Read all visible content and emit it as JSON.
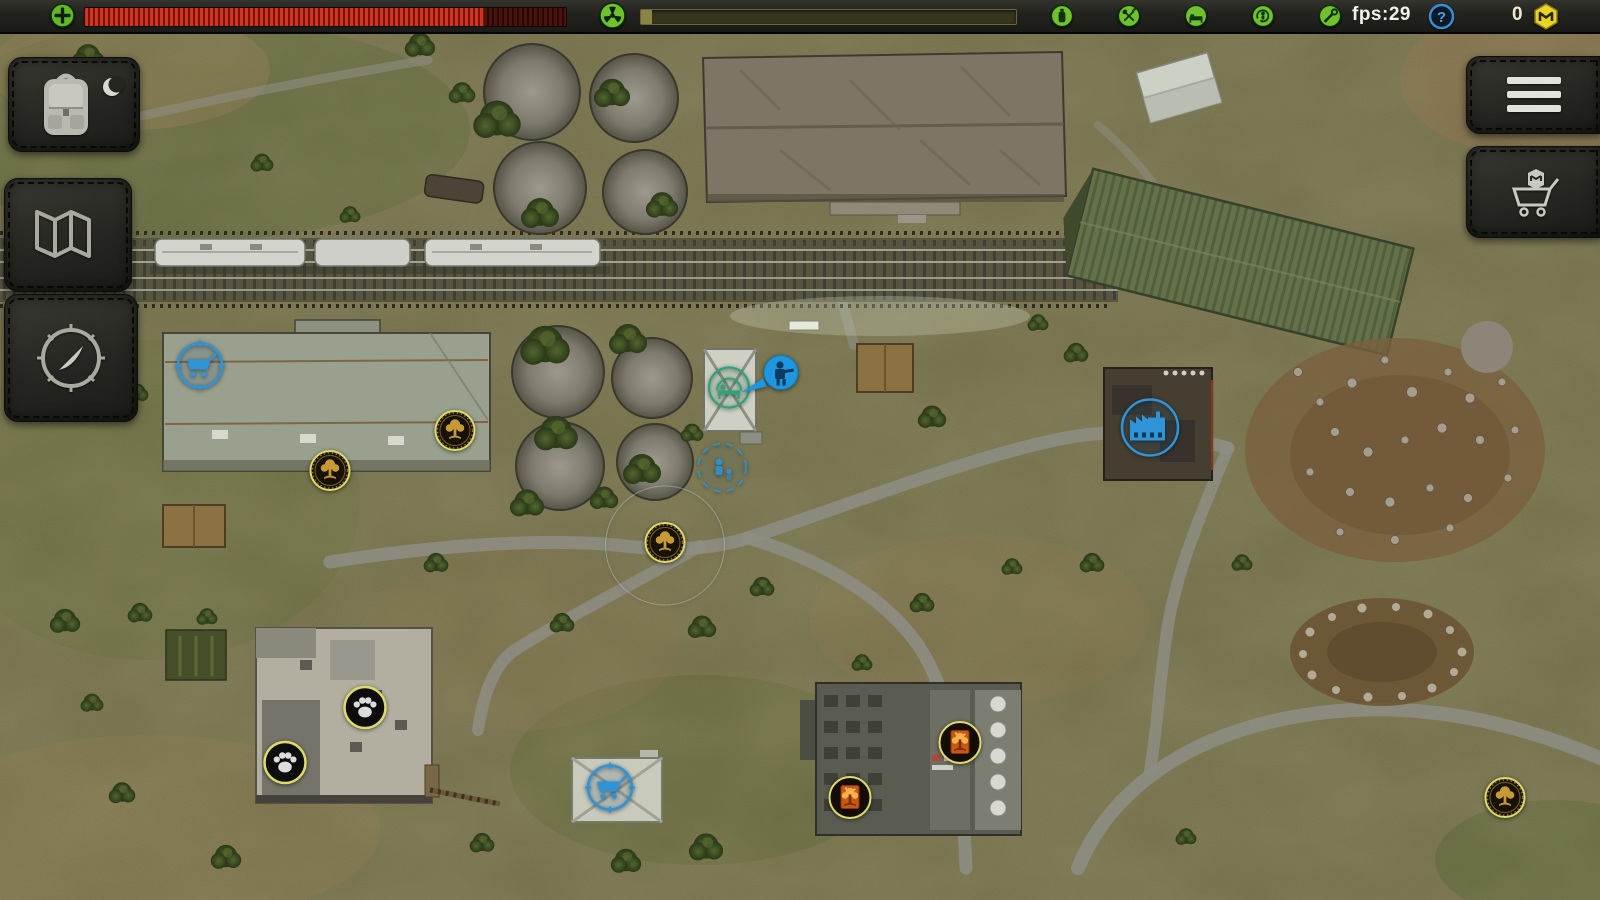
{
  "hud": {
    "health": {
      "icon": "health-cross-icon",
      "fill_pct": 83
    },
    "radiation": {
      "icon": "radiation-icon",
      "fill_pct": 3
    },
    "status_icons": [
      {
        "name": "drink-icon"
      },
      {
        "name": "food-icon"
      },
      {
        "name": "sleep-icon"
      },
      {
        "name": "stamina-icon"
      },
      {
        "name": "tools-icon"
      }
    ],
    "fps_label": "fps:29",
    "help_glyph": "?",
    "mail": {
      "count": "0",
      "icon": "mail-monogram-icon"
    }
  },
  "left_toolbar": {
    "buttons": [
      {
        "id": "inventory",
        "icon": "backpack-icon",
        "overlay": "moon-icon"
      },
      {
        "id": "world-map",
        "icon": "map-icon"
      },
      {
        "id": "compass",
        "icon": "compass-icon"
      }
    ]
  },
  "right_toolbar": {
    "buttons": [
      {
        "id": "menu",
        "icon": "hamburger-menu-icon"
      },
      {
        "id": "shop",
        "icon": "shop-cart-icon"
      }
    ]
  },
  "map": {
    "markers": [
      {
        "type": "trader-cart",
        "x": 200,
        "y": 368
      },
      {
        "type": "loot-medallion",
        "x": 455,
        "y": 433
      },
      {
        "type": "loot-medallion",
        "x": 330,
        "y": 473
      },
      {
        "type": "loot-medallion",
        "x": 665,
        "y": 545,
        "range_circle": true
      },
      {
        "type": "loot-medallion",
        "x": 1505,
        "y": 800
      },
      {
        "type": "shelter",
        "x": 729,
        "y": 390
      },
      {
        "type": "player",
        "x": 772,
        "y": 380
      },
      {
        "type": "companion",
        "x": 722,
        "y": 470
      },
      {
        "type": "factory",
        "x": 1150,
        "y": 430
      },
      {
        "type": "animal-paw",
        "x": 365,
        "y": 710
      },
      {
        "type": "animal-paw",
        "x": 285,
        "y": 765
      },
      {
        "type": "fire-loot-medallion",
        "x": 960,
        "y": 745
      },
      {
        "type": "fire-loot-medallion",
        "x": 850,
        "y": 800
      },
      {
        "type": "trader-cart",
        "x": 610,
        "y": 790
      }
    ]
  },
  "colors": {
    "accent_green": "#6cc428",
    "accent_red": "#cc2d1c",
    "accent_blue": "#2f93d8",
    "accent_yellow": "#e6d522",
    "medallion_gold": "#c79a33",
    "medallion_rim": "#dedb66"
  }
}
